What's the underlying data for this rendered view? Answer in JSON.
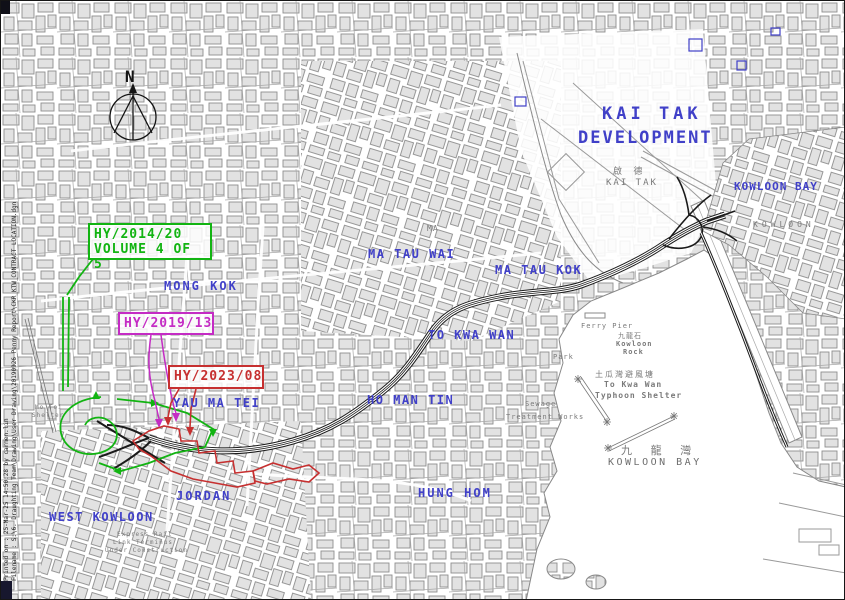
{
  "map": {
    "north_label": "N",
    "plot": {
      "printed_on": "Printed on :   25-Mar-25 14:50:28    by carmen.lin",
      "filename": "Filename :   S:\\6. Draughting Team\\Drawing\\User Drawing\\20190926_Penny Report\\CKR_KTW_CONTRACT LOCATION.dgn"
    },
    "contracts": [
      {
        "id": "HY/2014/20",
        "volume": "VOLUME 4 OF 5",
        "color": "#12b412"
      },
      {
        "id": "HY/2019/13",
        "color": "#c42cc4"
      },
      {
        "id": "HY/2023/08",
        "color": "#c63030"
      }
    ],
    "districts": [
      {
        "text": "MONG KOK"
      },
      {
        "text": "MA TAU WAI"
      },
      {
        "text": "MA TAU KOK"
      },
      {
        "text": "TO KWA WAN"
      },
      {
        "text": "HO MAN TIN"
      },
      {
        "text": "YAU MA TEI"
      },
      {
        "text": "JORDAN"
      },
      {
        "text": "WEST KOWLOON"
      },
      {
        "text": "HUNG HOM"
      },
      {
        "text": "KOWLOON BAY"
      },
      {
        "text": "KAI TAK"
      },
      {
        "text": "DEVELOPMENT"
      }
    ],
    "grey_labels": [
      {
        "text": "啟 德"
      },
      {
        "text": "KAI TAK"
      },
      {
        "text": "九龍石"
      },
      {
        "text": "Kowloon"
      },
      {
        "text": "Rock"
      },
      {
        "text": "土瓜灣避風塘"
      },
      {
        "text": "To Kwa Wan"
      },
      {
        "text": "Typhoon Shelter"
      },
      {
        "text": "Sewage"
      },
      {
        "text": "Treatment  Works"
      },
      {
        "text": "九 龍 灣"
      },
      {
        "text": "KOWLOON BAY"
      },
      {
        "text": "KOWLOON"
      },
      {
        "text": "Ferry Pier"
      },
      {
        "text": "Park"
      },
      {
        "text": "MA"
      },
      {
        "text": "Express Rail"
      },
      {
        "text": "Link Terminus"
      },
      {
        "text": "Under Construction"
      },
      {
        "text": "Mo Toi"
      },
      {
        "text": "Shelter"
      }
    ],
    "colors": {
      "district_label": "#4040c8",
      "alignment": "#1a1a1a",
      "contract_hy_2014_20": "#12b412",
      "contract_hy_2019_13": "#c42cc4",
      "contract_hy_2023_08": "#c63030",
      "base_map_grey": "#8e8e8e"
    }
  }
}
